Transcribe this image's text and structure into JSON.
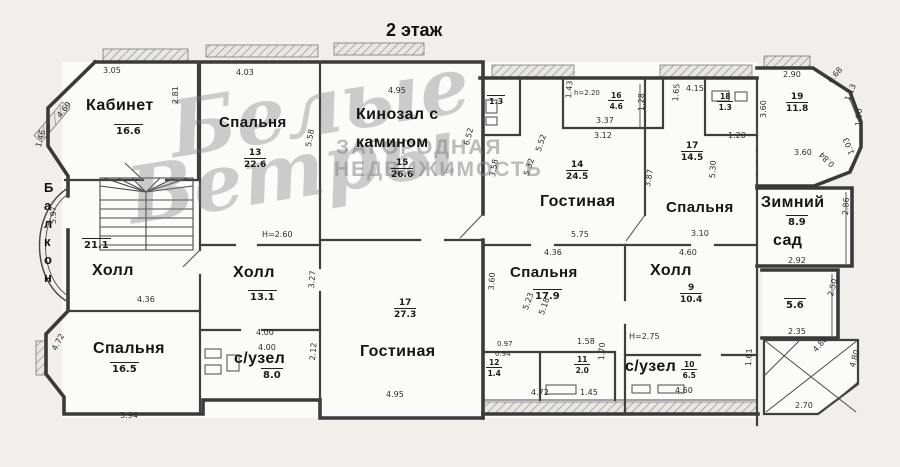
{
  "title": "2 этаж",
  "watermark": {
    "script1": "Белые",
    "script2": "Ветры",
    "caps1": "ЗАГОРОДНАЯ",
    "caps2": "НЕДВИЖИМОСТЬ"
  },
  "balcony": {
    "letters": [
      "Б",
      "а",
      "л",
      "к",
      "о",
      "н"
    ]
  },
  "rooms": {
    "kabinet": {
      "name": "Кабинет",
      "area": "16.6"
    },
    "bedroom_top": {
      "name": "Спальня",
      "number": "13",
      "area": "22.6"
    },
    "cinema": {
      "name_line1": "Кинозал с",
      "name_line2": "камином",
      "number": "15",
      "area": "26.6"
    },
    "hall_left": {
      "name": "Холл",
      "area": "21.1"
    },
    "bedroom_left": {
      "name": "Спальня",
      "area": "16.5"
    },
    "hall_mid": {
      "name": "Холл",
      "area": "13.1"
    },
    "wc_mid": {
      "name": "с/узел",
      "area": "8.0"
    },
    "living_bottom": {
      "name": "Гостиная",
      "number": "17",
      "area": "27.3"
    },
    "living_right": {
      "name": "Гостиная",
      "number": "14",
      "area": "24.5"
    },
    "bedroom_right": {
      "name": "Спальня",
      "number": "17",
      "area": "14.5"
    },
    "room16": {
      "number": "16",
      "area": "4.6"
    },
    "tiny_wc": {
      "area": "1.3"
    },
    "room18": {
      "number": "18",
      "area": "1.3"
    },
    "room19": {
      "number": "19",
      "area": "11.8"
    },
    "winter_garden": {
      "name_line1": "Зимний",
      "name_line2": "сад",
      "area": "8.9"
    },
    "room_56": {
      "area": "5.6"
    },
    "bedroom_bottom": {
      "name": "Спальня",
      "area": "17.9"
    },
    "hall_right": {
      "name": "Холл",
      "number": "9",
      "area": "10.4"
    },
    "wc_right": {
      "name": "с/узел",
      "number": "10",
      "area": "6.5"
    },
    "room11": {
      "number": "11",
      "area": "2.0"
    },
    "room12": {
      "number": "12",
      "area": "1.4"
    }
  },
  "dims": [
    "3.05",
    "4.69",
    "1.46",
    "2.81",
    "4.03",
    "5.58",
    "4.95",
    "6.52",
    "4.36",
    "5.97",
    "4.72",
    "3.94",
    "H=2.60",
    "4.00",
    "4.00",
    "3.27",
    "2.12",
    "4.95",
    "3.58",
    "5.52",
    "5.32",
    "3.87",
    "5.75",
    "4.15",
    "1.65",
    "h=2.20",
    "3.37",
    "3.12",
    "1.43",
    "1.28",
    "2.90",
    "3.60",
    "3.60",
    "0.68",
    "1.13",
    "1.90",
    "1.03",
    "0.84",
    "1.20",
    "5.30",
    "3.10",
    "4.60",
    "4.36",
    "5.23",
    "5.18",
    "3.60",
    "H=2.75",
    "0.97",
    "0.94",
    "1.58",
    "1.45",
    "4.72",
    "1.70",
    "4.60",
    "1.61",
    "2.92",
    "2.86",
    "2.35",
    "2.50",
    "2.70",
    "4.88",
    "4.80"
  ],
  "colors": {
    "wall": "#3a3a3a",
    "paper": "#f0efec",
    "room_fill": "#fbfbfa"
  }
}
